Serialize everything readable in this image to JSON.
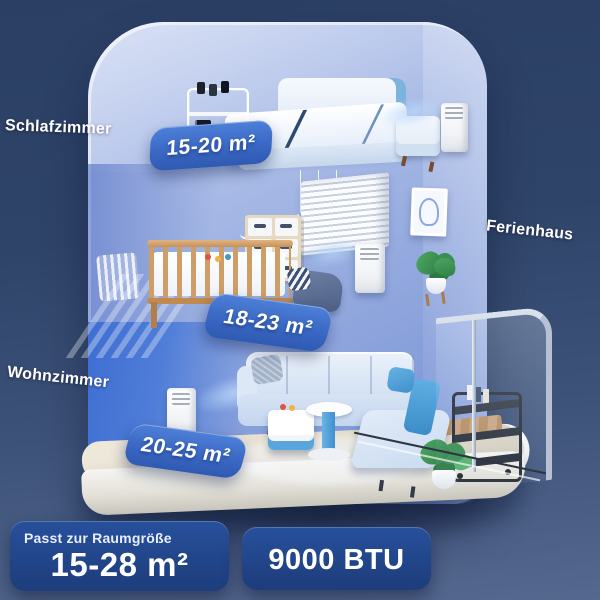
{
  "room_labels": {
    "bedroom": "Schlafzimmer",
    "house": "Ferienhaus",
    "living_room": "Wohnzimmer"
  },
  "area_badges": {
    "bedroom": "15-20 m²",
    "nursery": "18-23 m²",
    "living_room": "20-25 m²"
  },
  "footer": {
    "caption": "Passt zur Raumgröße",
    "size_value": "15-28 m²",
    "btu_value": "9000 BTU"
  },
  "colors": {
    "background_top": "#2b3f65",
    "background_bottom": "#55688f",
    "badge_blue": "#3a68c4",
    "info_box_blue": "#1f4386",
    "wall_periwinkle": "#9db3e6",
    "accent_wall_blue": "#3e6ed2",
    "floor_beige": "#e9e4d8"
  },
  "illustration": {
    "scene": "ferienhaus-cutaway-three-floors",
    "ac_unit_count": 3
  }
}
